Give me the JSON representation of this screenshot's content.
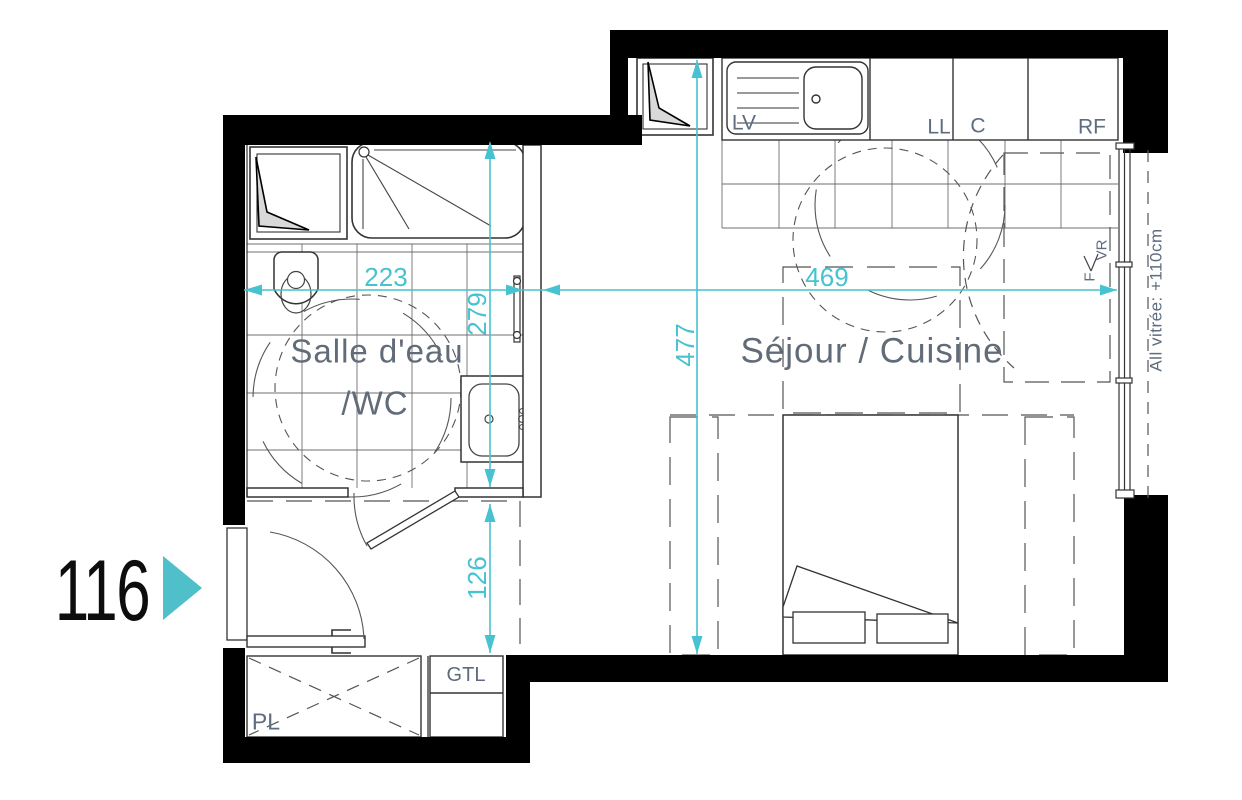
{
  "unit": {
    "number": "116"
  },
  "rooms": {
    "bathroom": {
      "line1": "Salle d'eau",
      "line2": "/WC"
    },
    "living": {
      "label": "Séjour / Cuisine"
    }
  },
  "kitchen": {
    "dishwasher": "LV",
    "washer": "LL",
    "cooktop": "C",
    "fridge": "RF"
  },
  "window": {
    "f": "F",
    "vr": "VR",
    "note": "All vitrée: +110cm"
  },
  "utility": {
    "gtl": "GTL",
    "closet": "PL"
  },
  "dimensions": {
    "bath_width_cm": "223",
    "bath_depth_cm": "279",
    "living_width_cm": "469",
    "living_depth_cm": "477",
    "entry_depth_cm": "126"
  },
  "colors": {
    "accent": "#4FBFC9",
    "dim": "#47C2D1",
    "wall": "#000000",
    "label": "#5D6C7E",
    "room": "#626C79",
    "unit": "#0d0d0d"
  }
}
